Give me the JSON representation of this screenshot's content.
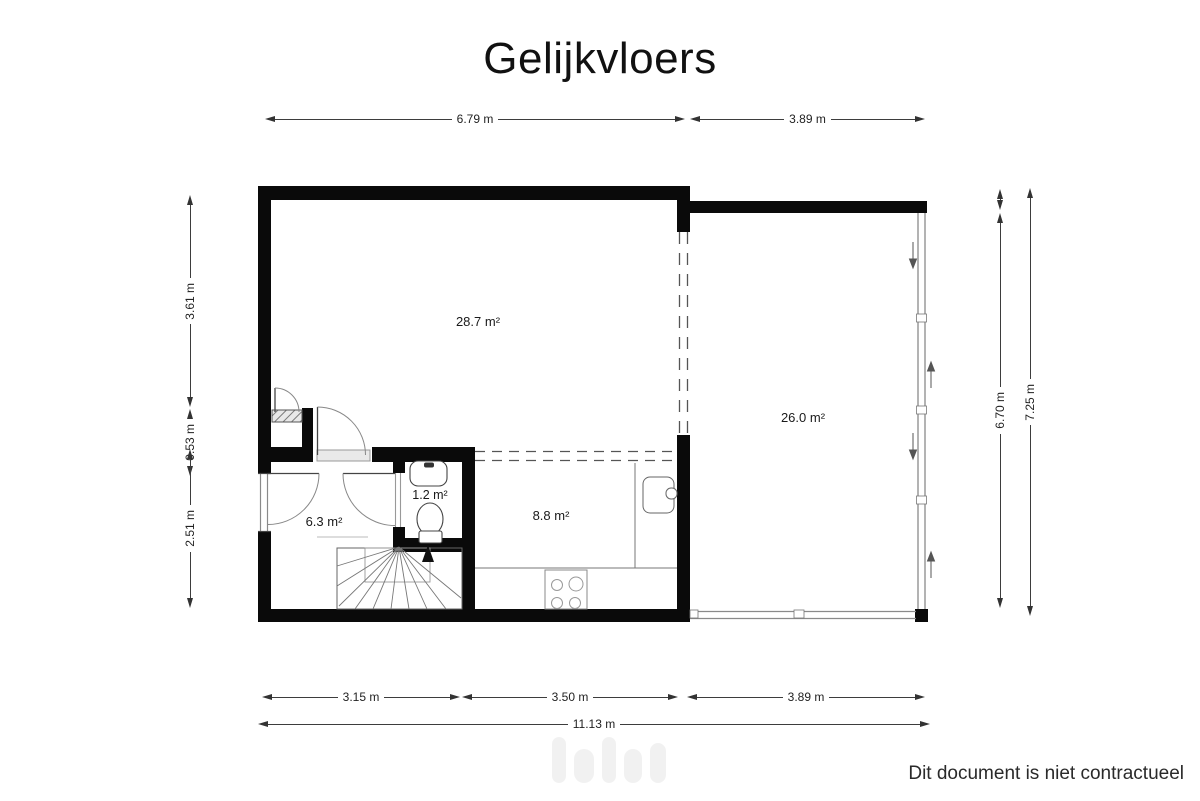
{
  "title": "Gelijkvloers",
  "disclaimer": "Dit document is niet contractueel",
  "rooms": {
    "living": "28.7 m²",
    "terrace": "26.0 m²",
    "kitchen": "8.8 m²",
    "hall": "6.3 m²",
    "wc": "1.2 m²"
  },
  "dims": {
    "top": [
      "6.79 m",
      "3.89 m"
    ],
    "left": [
      "3.61 m",
      "0.53 m",
      "2.51 m"
    ],
    "right": [
      "6.70 m",
      "7.25 m"
    ],
    "bottom": [
      "3.15 m",
      "3.50 m",
      "3.89 m"
    ],
    "total": "11.13 m"
  },
  "colors": {
    "wall": "#0a0a0a",
    "dimension_line": "#3d3d3d",
    "thin_line": "#777777",
    "glass": "#8a8a8a"
  }
}
